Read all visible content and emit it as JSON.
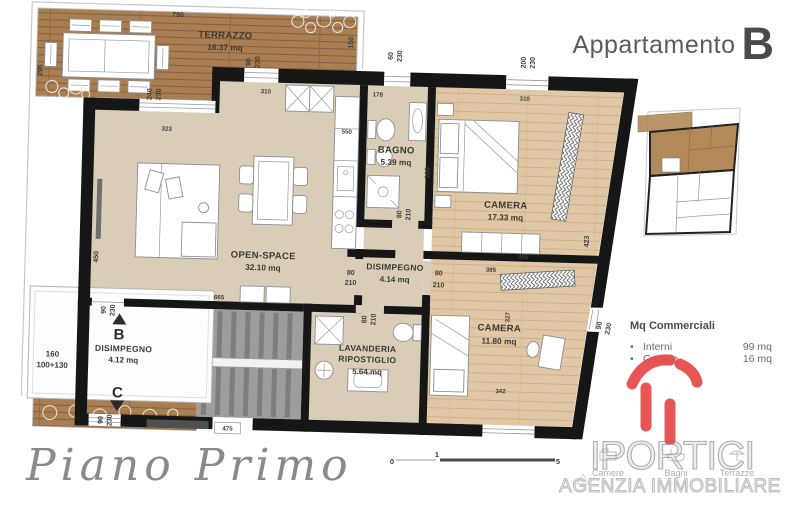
{
  "title": {
    "prefix": "Appartamento",
    "letter": "B"
  },
  "floor_label": "Piano Primo",
  "rooms": {
    "terrazzo": {
      "name": "TERRAZZO",
      "area": "16.37 mq"
    },
    "open_space": {
      "name": "OPEN-SPACE",
      "area": "32.10 mq"
    },
    "bagno": {
      "name": "BAGNO",
      "area": "5.39 mq"
    },
    "camera1": {
      "name": "CAMERA",
      "area": "17.33 mq"
    },
    "disimpegno1": {
      "name": "DISIMPEGNO",
      "area": "4.14 mq"
    },
    "camera2": {
      "name": "CAMERA",
      "area": "11.80 mq"
    },
    "lavanderia": {
      "name1": "LAVANDERIA",
      "name2": "RIPOSTIGLIO",
      "area": "5.64 mq"
    },
    "disimpegno2": {
      "name": "DISIMPEGNO",
      "area": "4.12 mq"
    }
  },
  "stairs": {
    "up_label": "B",
    "down_label": "C"
  },
  "dims": {
    "d790": "790",
    "d296": "296",
    "d150": "150",
    "d240": "240",
    "d230": "230",
    "d90": "90",
    "d60": "60",
    "d200": "200",
    "d310": "310",
    "d178": "178",
    "d550": "550",
    "d323": "323",
    "d450": "450",
    "d665": "665",
    "d80": "80",
    "d210": "210",
    "d308": "308",
    "d385": "385",
    "d423": "423",
    "d327": "327",
    "d342": "342",
    "d475": "475",
    "d160": "160",
    "d100_130": "100+130"
  },
  "legend": {
    "title": "Mq Commerciali",
    "bullet": "•",
    "items": [
      {
        "label": "Interni",
        "value": "99 mq"
      },
      {
        "label": "Garage",
        "value": "16 mq"
      }
    ]
  },
  "scale_bar": {
    "start": "0",
    "mid": "1",
    "end": "5"
  },
  "logo": {
    "wordmark": "IPORTICI",
    "subtitle": "AGENZIA IMMOBILIARE",
    "footer_items": [
      "Camere",
      "Bagni",
      "Terrazze"
    ]
  },
  "colors": {
    "accent_red": "#e64c4c",
    "wall": "#161616",
    "wood_terrace": "#a87e52",
    "wood_room": "#e0c8a6",
    "floor_beige": "#d9cdb7",
    "stair_grey": "#9d9d9d",
    "keyplan_brown": "#b28a59"
  }
}
